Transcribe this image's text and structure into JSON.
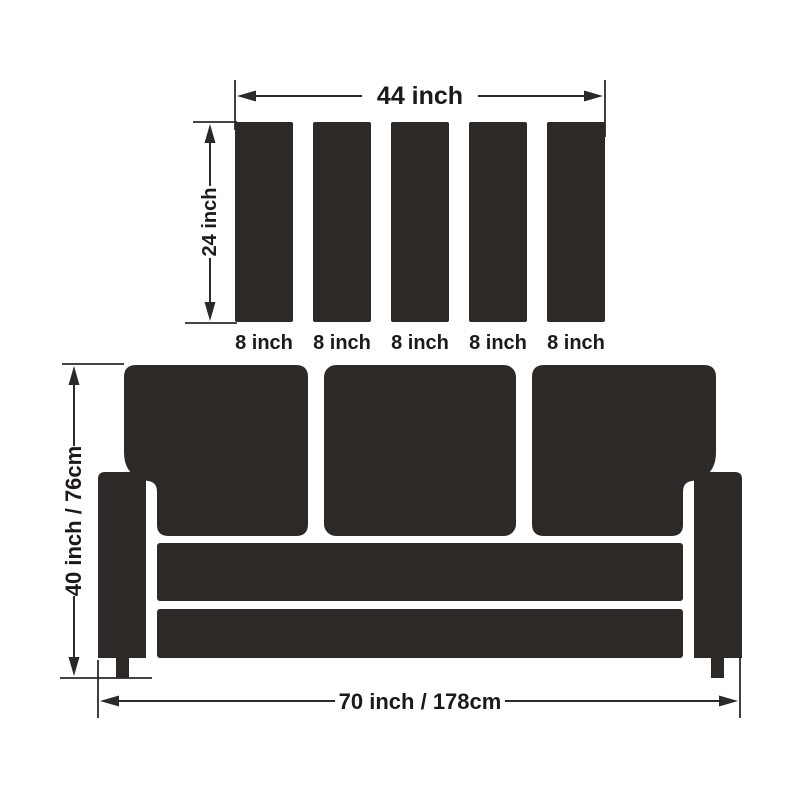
{
  "colors": {
    "shape_fill": "#2d2926",
    "line": "#2c2a29",
    "text": "#1c1917",
    "background": "#ffffff"
  },
  "panel_diagram": {
    "width_label": "44 inch",
    "height_label": "24 inch",
    "panel_labels": [
      "8 inch",
      "8 inch",
      "8 inch",
      "8 inch",
      "8 inch"
    ]
  },
  "sofa_diagram": {
    "height_label": "40 inch / 76cm",
    "width_label": "70 inch / 178cm"
  }
}
